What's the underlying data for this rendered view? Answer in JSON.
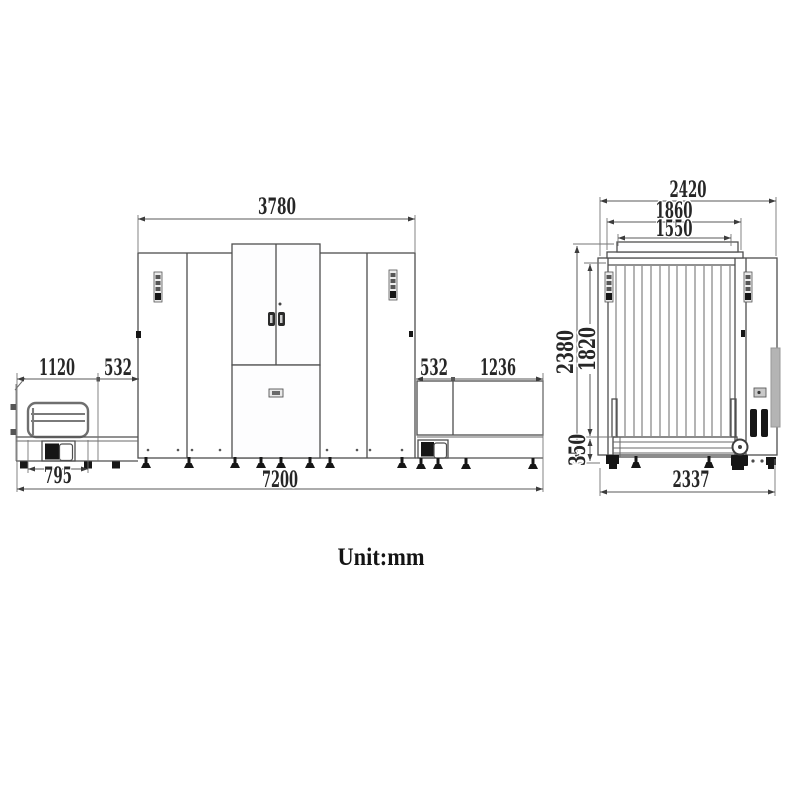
{
  "caption": {
    "unit_label": "Unit:mm"
  },
  "side_view": {
    "name": "side-elevation",
    "dims": {
      "body_width": "3780",
      "entry_overhang": "1120",
      "entry_gap": "532",
      "exit_gap": "532",
      "exit_overhang": "1236",
      "entry_table_width": "795",
      "total_length": "7200"
    }
  },
  "end_view": {
    "name": "end-elevation",
    "dims": {
      "overall_width": "2420",
      "body_width": "1860",
      "tunnel_width": "1550",
      "overall_height": "2380",
      "tunnel_height": "1820",
      "belt_height": "350",
      "base_width": "2337"
    }
  }
}
